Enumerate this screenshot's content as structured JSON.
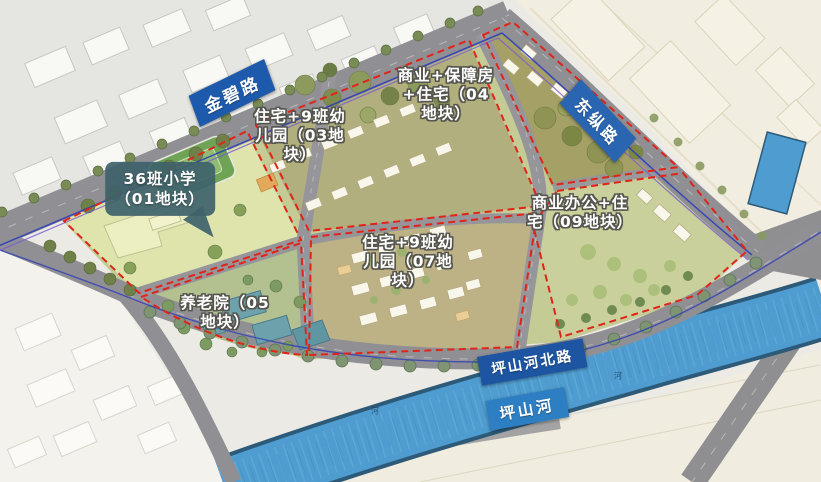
{
  "map": {
    "roads": {
      "jinbi_road": "金碧路",
      "dongzong_road": "东纵路",
      "pingshan_north_road": "坪山河北路"
    },
    "river": {
      "name": "坪山河",
      "tiny_marks": [
        "河",
        "河"
      ]
    },
    "plots": {
      "p01": "36班小学\n（01地块）",
      "p03": "住宅+9班幼\n儿园（03地\n块）",
      "p04": "商业+保障房\n+住宅（04\n地块）",
      "p05": "养老院（05\n地块）",
      "p07": "住宅+9班幼\n儿园（07地\n块）",
      "p09": "商业办公+住\n宅（09地块）"
    },
    "colors": {
      "road_label_blue": "#1e5aab",
      "river_label_blue": "#2d7ec2",
      "boundary_red": "#e02418",
      "river_blue": "#4f9dd0",
      "callout_teal": "#3e626a",
      "road_gray": "#909094",
      "site_green": "#c5cb95"
    }
  }
}
